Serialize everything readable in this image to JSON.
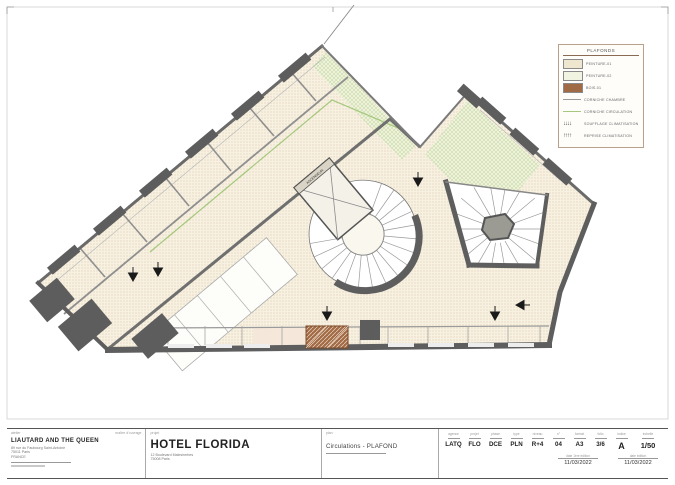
{
  "colors": {
    "wall": "#5e5e5e",
    "peinture_01": "#efe6cf",
    "peinture_02": "#f1f4e1",
    "bois_01": "#a06a44",
    "corniche_chambre": "#9a9a9a",
    "corniche_circulation": "#a5c87d"
  },
  "legend": {
    "title": "PLAFONDS",
    "items": [
      {
        "label": "PEINTURE-01"
      },
      {
        "label": "PEINTURE-02"
      },
      {
        "label": "BOIS-01"
      },
      {
        "label": "CORNICHE CHAMBRE"
      },
      {
        "label": "CORNICHE CIRCULATION"
      },
      {
        "label": "SOUFFLAGE CLIMATISATION",
        "glyph": "↓↓↓↓"
      },
      {
        "label": "REPRISE CLIMATISATION",
        "glyph": "↑↑↑↑"
      }
    ]
  },
  "plan": {
    "elevator_label": "ASCENSEUR"
  },
  "title_block": {
    "architect": {
      "header_left": "atelier",
      "header_right": "maître d'ouvrage",
      "name": "LIAUTARD AND THE QUEEN",
      "address_lines": [
        "89 rue du Faubourg Saint-Antoine",
        "75011 Paris",
        "FRANCE"
      ]
    },
    "project": {
      "header": "projet",
      "name": "HOTEL FLORIDA",
      "address_lines": [
        "12 Boulevard Malesherbes",
        "75008 Paris"
      ]
    },
    "drawing": {
      "header": "plan",
      "title": "Circulations - PLAFOND"
    },
    "codes": [
      {
        "label": "agence",
        "value": "LATQ"
      },
      {
        "label": "projet",
        "value": "FLO"
      },
      {
        "label": "phase",
        "value": "DCE"
      },
      {
        "label": "type",
        "value": "PLN"
      },
      {
        "label": "niveau",
        "value": "R+4"
      },
      {
        "label": "n°",
        "value": "04"
      },
      {
        "label": "format",
        "value": "A3"
      },
      {
        "label": "folio",
        "value": "3/6"
      },
      {
        "label": "indice",
        "value": "A"
      },
      {
        "label": "échelle",
        "value": "1/50"
      }
    ],
    "dates": [
      {
        "label": "date 1ère édition",
        "value": "11/03/2022"
      },
      {
        "label": "date édition",
        "value": "11/03/2022"
      }
    ]
  }
}
